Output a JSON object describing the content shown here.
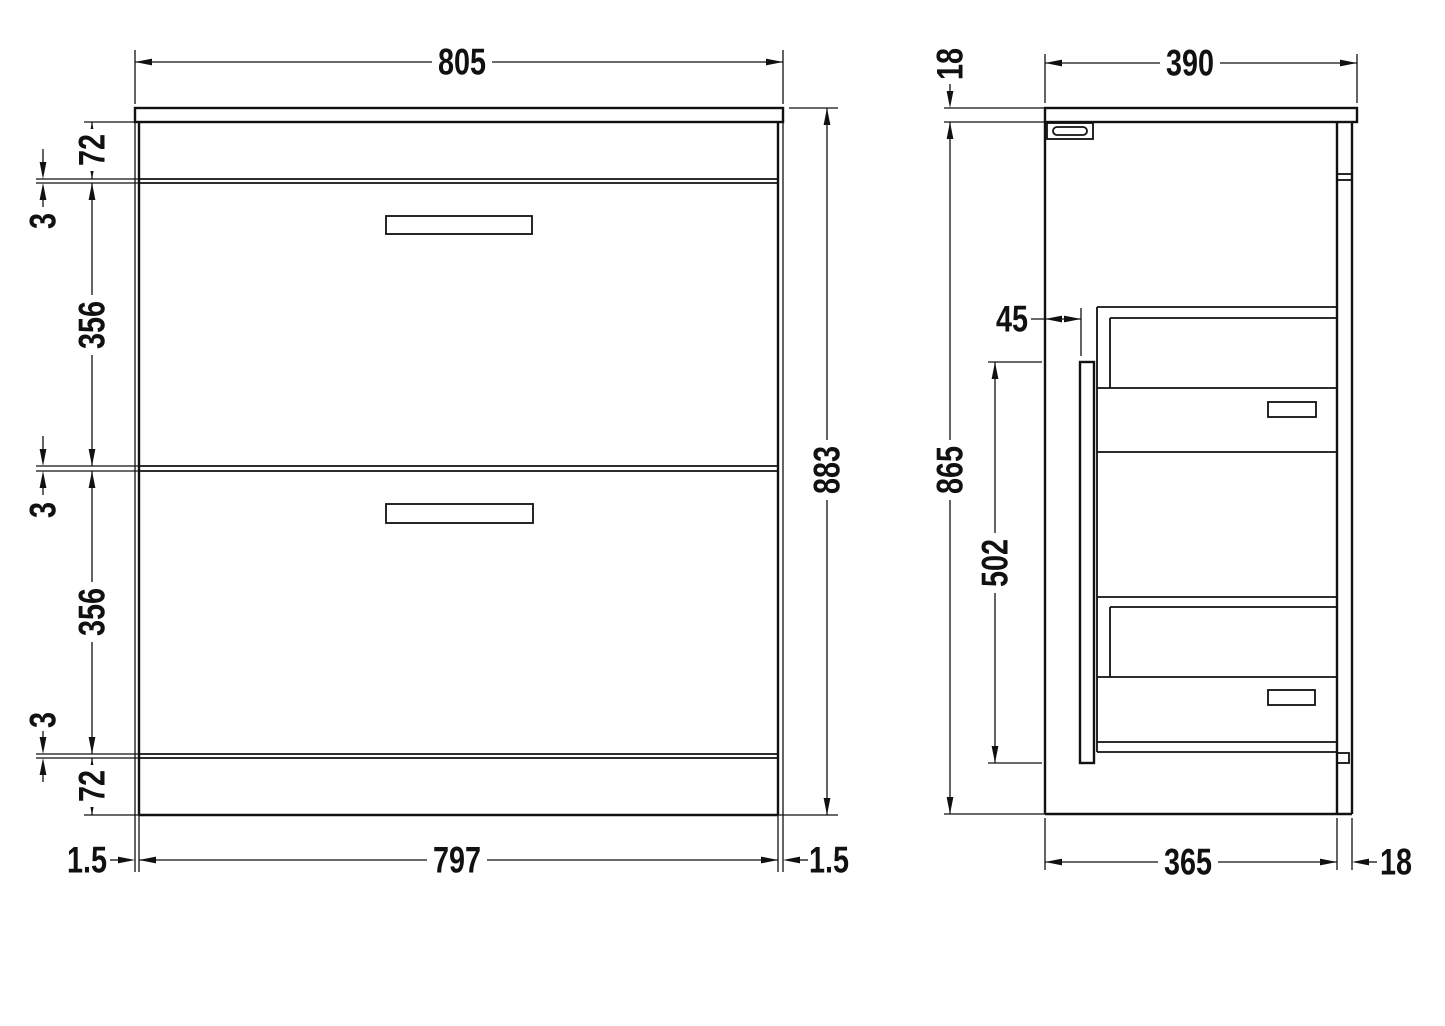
{
  "colors": {
    "line": "#111111",
    "background": "#ffffff"
  },
  "front_view": {
    "overall_width": "805",
    "overall_height": "883",
    "carcass_width": "797",
    "top_rail_height": "72",
    "bottom_rail_height": "72",
    "drawer_front_height_upper": "356",
    "drawer_front_height_lower": "356",
    "drawer_gap_top": "3",
    "drawer_gap_middle": "3",
    "drawer_gap_bottom": "3",
    "worktop_overhang_left": "1.5",
    "worktop_overhang_right": "1.5"
  },
  "side_view": {
    "worktop_thickness": "18",
    "overall_depth": "390",
    "drawer_box_inset": "45",
    "drawer_zone_height": "502",
    "cabinet_height": "865",
    "carcass_depth": "365",
    "back_panel_thickness": "18"
  }
}
